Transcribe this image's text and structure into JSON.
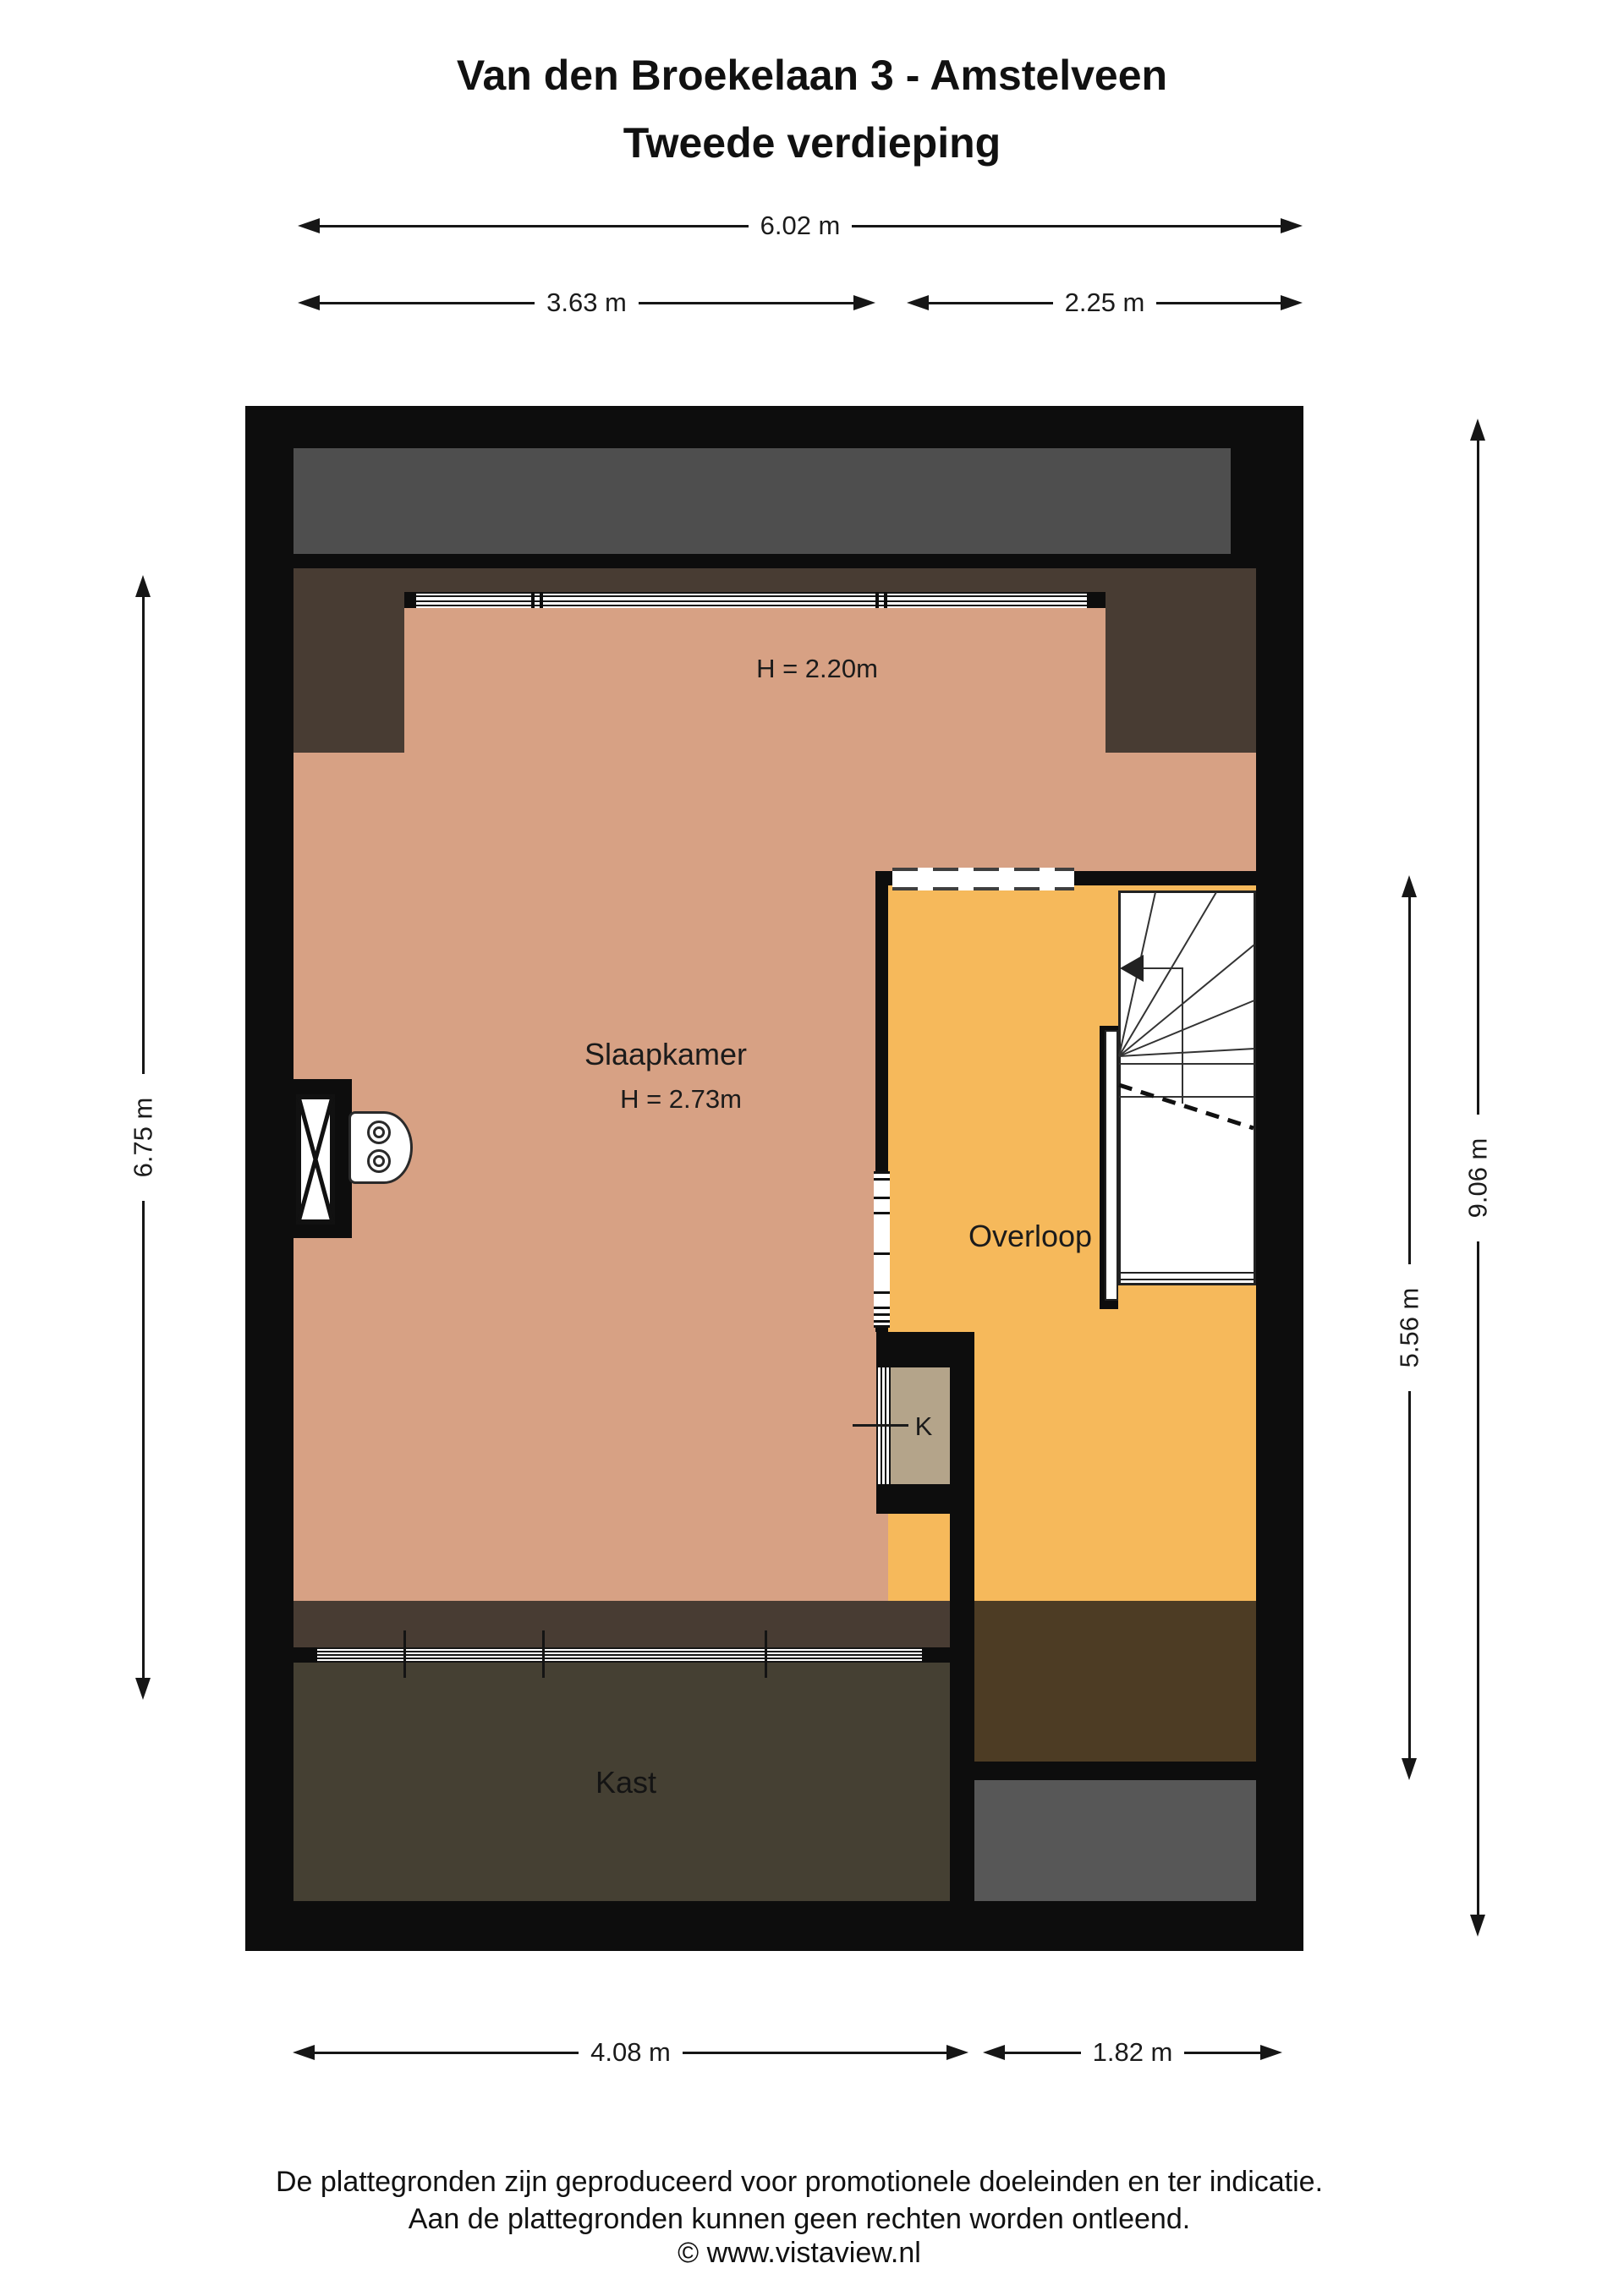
{
  "title": {
    "line1": "Van den Broekelaan 3 - Amstelveen",
    "line2": "Tweede verdieping"
  },
  "rooms": {
    "slaapkamer": "Slaapkamer",
    "slaapkamer_height": "H = 2.73m",
    "attic_height": "H = 2.20m",
    "overloop": "Overloop",
    "kast": "Kast",
    "k": "K"
  },
  "dimensions": {
    "top_total": "6.02 m",
    "top_left": "3.63 m",
    "top_right": "2.25 m",
    "left_side": "6.75 m",
    "right_full": "9.06 m",
    "right_inner": "5.56 m",
    "bottom_left": "4.08 m",
    "bottom_right": "1.82 m"
  },
  "footer": {
    "line1": "De plattegronden zijn geproduceerd voor promotionele doeleinden en ter indicatie.",
    "line2": "Aan de plattegronden kunnen geen rechten worden ontleend.",
    "line3": "© www.vistaview.nl"
  },
  "colors": {
    "wall": "#0d0d0d",
    "bedroom_floor": "#d7a184",
    "landing_floor": "#f6b95b",
    "roof_strip_gray": "#4e4e4e",
    "attic_low_brown": "#483c33",
    "closet_floor": "#454033",
    "right_room_brown": "#4d3c24",
    "right_room_gray": "#575757",
    "k_closet_floor": "#b4a48a"
  }
}
